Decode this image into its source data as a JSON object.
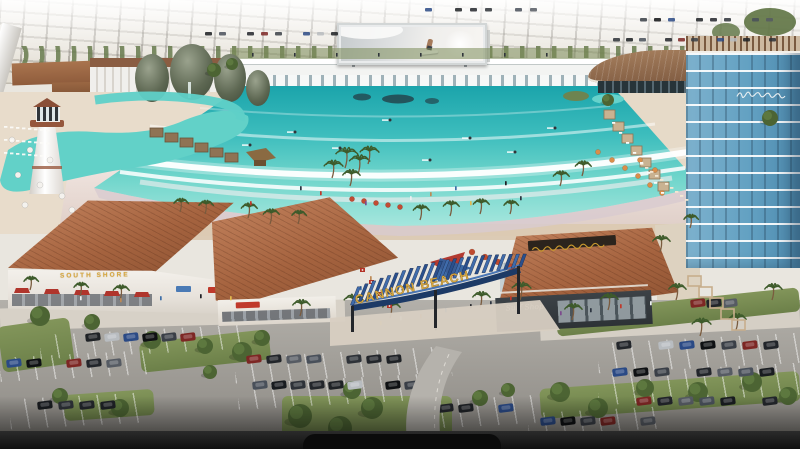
{
  "scene": {
    "description": "Aerial architectural rendering of the Cannon Beach surf resort: large turquoise wave pool with sandy beach, lagoon pools with lighthouse, beachfront retail village, hotel tower and parking lots",
    "billboard": {
      "content": "surfer riding a wave on a jumbotron screen"
    },
    "signs": {
      "entrance_arch": "CANNON BEACH",
      "left_retail": "SOUTH SHORE",
      "surf_shop": "Surf Shop"
    },
    "colors": {
      "water": "#4cc6c2",
      "water_deep": "#1ba4ab",
      "sand": "#ecdfda",
      "roof_terracotta": "#a5633f",
      "clubhouse_roof": "#8a6348",
      "hotel_blue": "#63a1c2",
      "arch_blue": "#24487e",
      "sign_gold": "#d9a941",
      "asphalt": "#a29f99",
      "grass": "#748753",
      "haze": "#e9e6df",
      "bottom_band": "#101010"
    }
  }
}
